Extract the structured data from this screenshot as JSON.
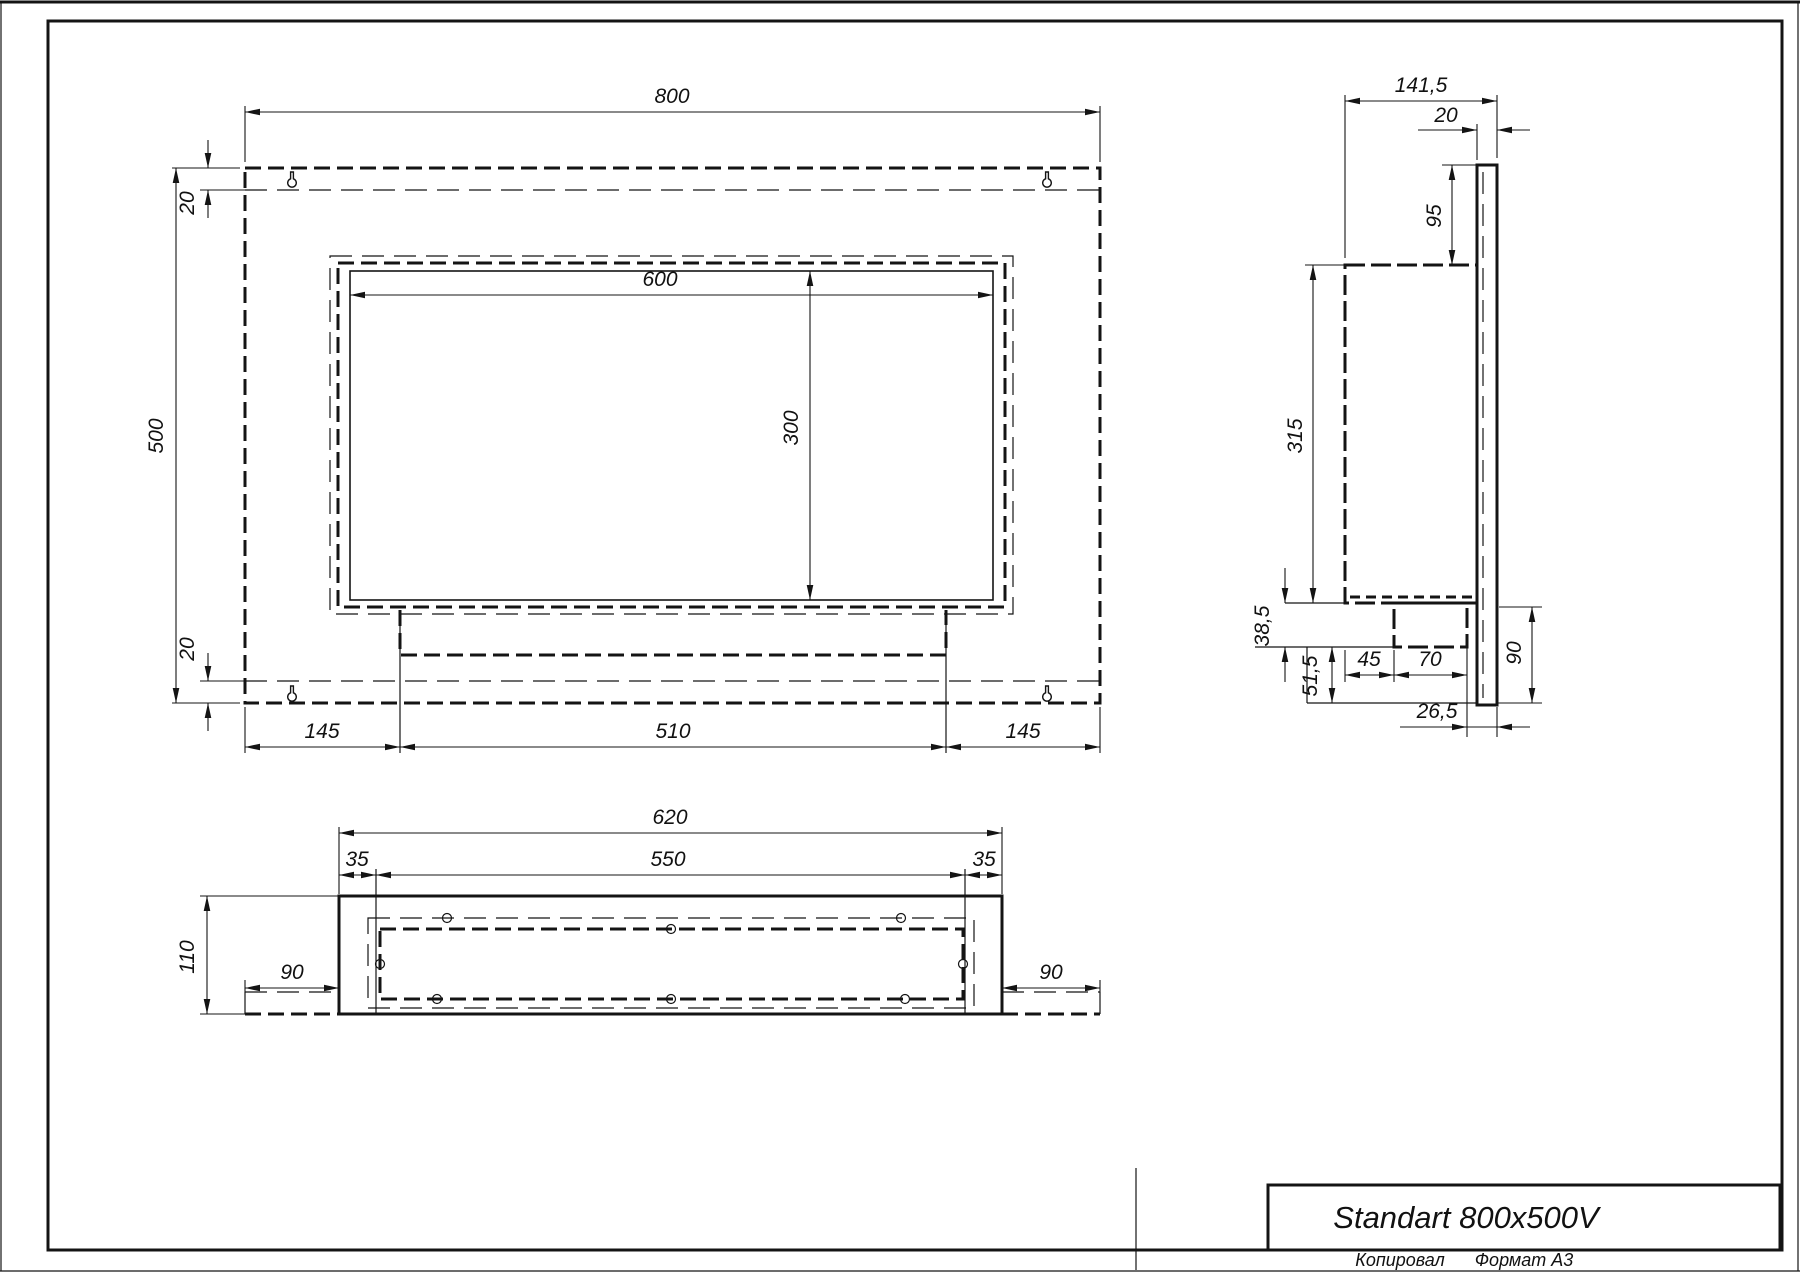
{
  "title_block": {
    "title": "Standart 800x500V",
    "copied_label": "Копировал",
    "format_label": "Формат A3"
  },
  "front_view": {
    "width": "800",
    "height": "500",
    "top_offset": "20",
    "bottom_offset": "20",
    "opening_width": "600",
    "opening_height": "300",
    "bottom_left": "145",
    "bottom_center": "510",
    "bottom_right": "145"
  },
  "side_view": {
    "overall_depth": "141,5",
    "plate_thickness": "20",
    "top_gap": "95",
    "body_height": "315",
    "step_height": "38,5",
    "lower_height": "51,5",
    "tray_setback": "45",
    "tray_depth": "70",
    "flange_height": "90",
    "back_offset": "26,5"
  },
  "bottom_view": {
    "outer_width": "620",
    "inner_width": "550",
    "side_left": "35",
    "side_right": "35",
    "depth": "110",
    "flange_left": "90",
    "flange_right": "90"
  },
  "icons": {
    "keyhole": "keyhole-wall-mount-slot"
  },
  "colors": {
    "line": "#141414",
    "paper": "#ffffff"
  }
}
